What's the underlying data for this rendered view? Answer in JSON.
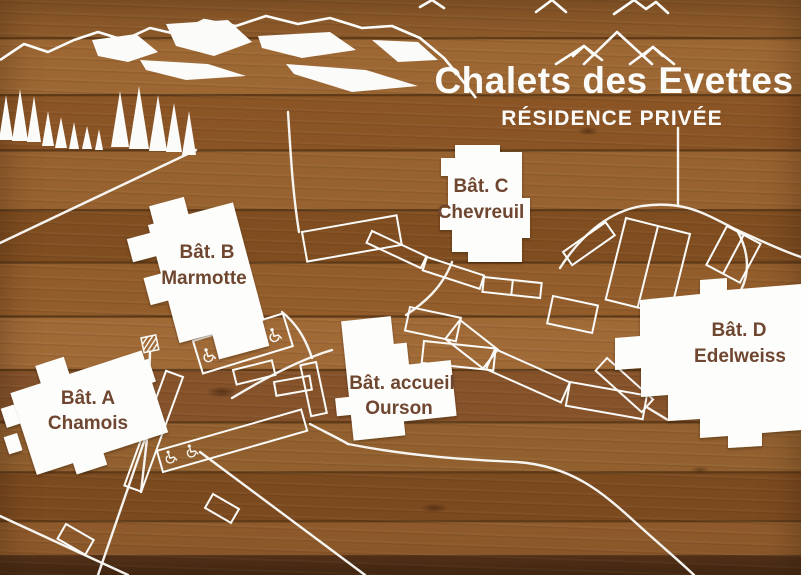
{
  "header": {
    "title": "Chalets des Evettes",
    "subtitle": "RÉSIDENCE PRIVÉE"
  },
  "buildings": [
    {
      "id": "bat-a",
      "line1": "Bât. A",
      "line2": "Chamois"
    },
    {
      "id": "bat-b",
      "line1": "Bât. B",
      "line2": "Marmotte"
    },
    {
      "id": "bat-c",
      "line1": "Bât. C",
      "line2": "Chevreuil"
    },
    {
      "id": "bat-accueil",
      "line1": "Bât. accueil",
      "line2": "Ourson"
    },
    {
      "id": "bat-d",
      "line1": "Bât. D",
      "line2": "Edelweiss"
    }
  ],
  "icons": [
    "mountain-peaks-icon",
    "mountain-ridge-icon",
    "pine-tree-icon",
    "wheelchair-icon",
    "hatched-marker-icon"
  ],
  "colors": {
    "wood": "#8f5a2a",
    "engraving": "#ffffff",
    "label_text": "#6f4630"
  }
}
